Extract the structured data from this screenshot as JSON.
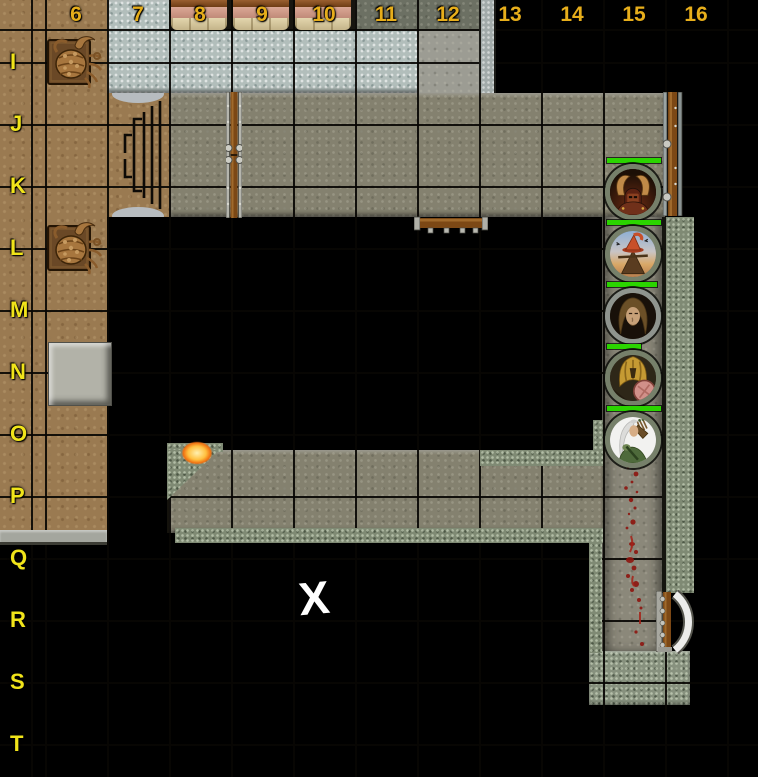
{
  "map": {
    "title": "dungeon-battle-map",
    "grid": {
      "column_labels": [
        "6",
        "7",
        "8",
        "9",
        "10",
        "11",
        "12",
        "13",
        "14",
        "15",
        "16"
      ],
      "row_labels": [
        "I",
        "J",
        "K",
        "L",
        "M",
        "N",
        "O",
        "P",
        "Q",
        "R",
        "S",
        "T"
      ],
      "column_label_color": "#e7ae1b",
      "row_label_color": "#f1e41a",
      "cell_size_px": 62
    },
    "marker": {
      "symbol": "X",
      "color": "#ffffff"
    },
    "tokens": [
      {
        "name": "horned-helmet-warrior",
        "cell": "K15",
        "health_bar": "full"
      },
      {
        "name": "scarecrow-witch",
        "cell": "L15",
        "health_bar": "full"
      },
      {
        "name": "long-haired-man",
        "cell": "M15",
        "health_bar": "full"
      },
      {
        "name": "golden-armored-figure",
        "cell": "N15",
        "health_bar": "partial"
      },
      {
        "name": "elf-archer",
        "cell": "O15",
        "health_bar": "full"
      }
    ],
    "creatures": [
      {
        "name": "giant-crab",
        "cell": "I6"
      },
      {
        "name": "giant-crab",
        "cell": "L6"
      }
    ],
    "features": [
      "beds",
      "staircase",
      "double-door",
      "wooden-doors",
      "torch",
      "pressure-plate",
      "blood-trail",
      "fog-of-war",
      "stone-walls"
    ],
    "colors": {
      "health_green": "#2bd400",
      "blood_red": "#8e150f",
      "wood_floor": "#9a7a51",
      "stone_floor": "#84816f",
      "bright_stone": "#b2bebb",
      "wall_stone": "#7f8a74",
      "door_wood": "#7c4815",
      "fog": "#000000"
    }
  }
}
